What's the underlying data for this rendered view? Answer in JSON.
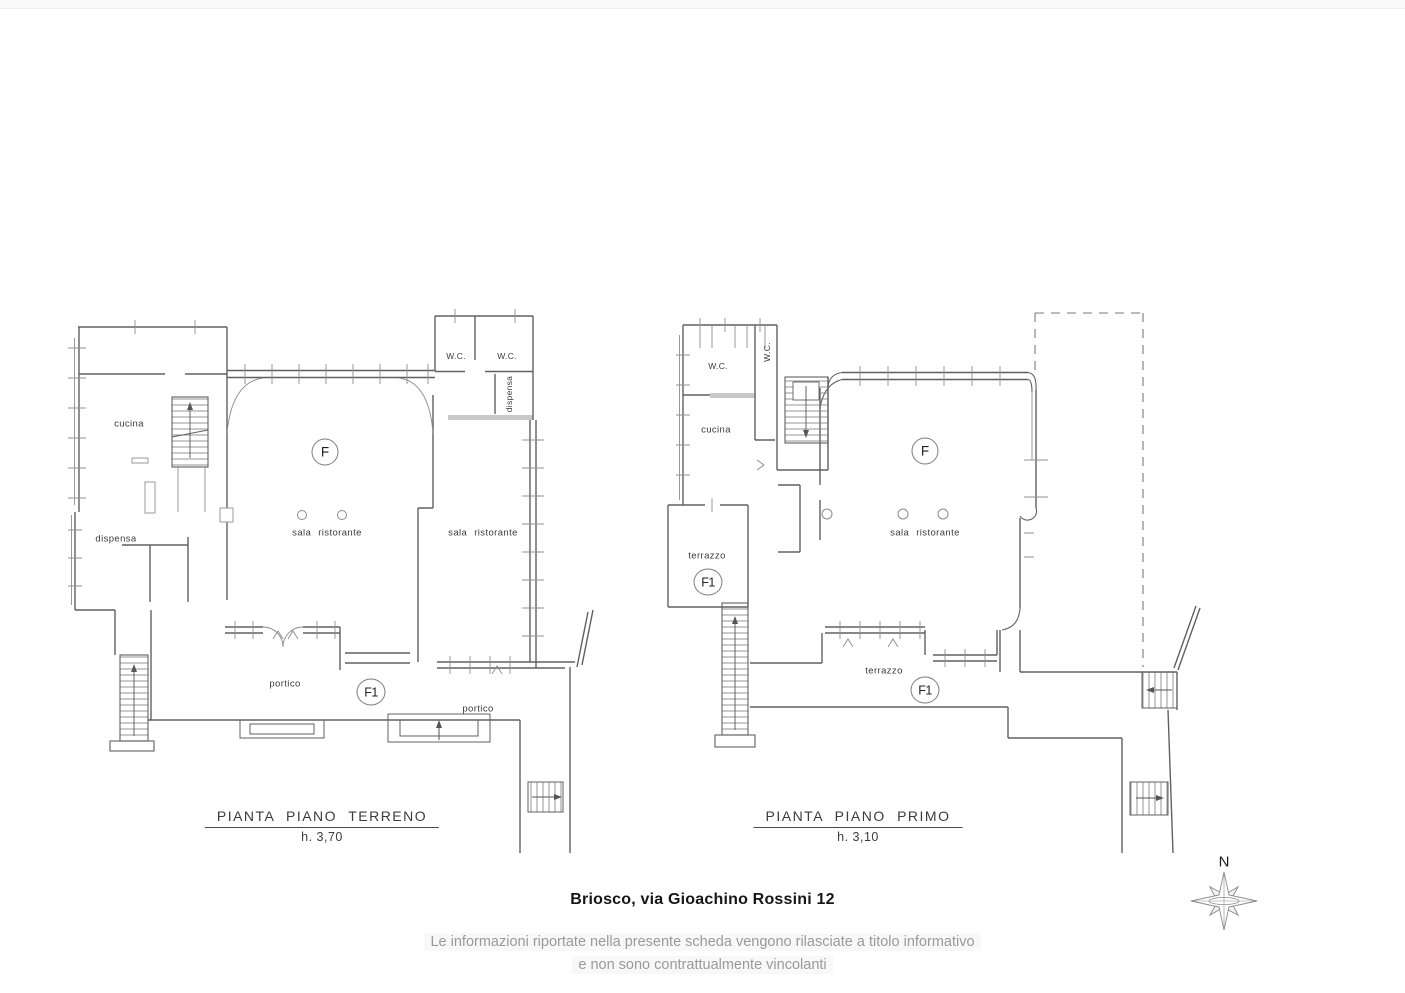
{
  "ground_floor": {
    "title": "PIANTA PIANO TERRENO",
    "height_label": "h. 3,70",
    "labels": {
      "cucina": "cucina",
      "dispensa_left": "dispensa",
      "wc_1": "W.C.",
      "wc_2": "W.C.",
      "dispensa_vertical": "dispensa",
      "sala_center": "sala ristorante",
      "sala_right": "sala ristorante",
      "portico_left": "portico",
      "portico_right": "portico",
      "unit_f": "F",
      "unit_f1": "F1"
    }
  },
  "first_floor": {
    "title": "PIANTA PIANO PRIMO",
    "height_label": "h. 3,10",
    "labels": {
      "wc_1": "W.C.",
      "wc_2": "W.C.",
      "cucina": "cucina",
      "sala": "sala ristorante",
      "terrazzo_left": "terrazzo",
      "terrazzo_center": "terrazzo",
      "unit_f": "F",
      "unit_f1_left": "F1",
      "unit_f1_center": "F1"
    }
  },
  "footer": {
    "address": "Briosco, via Gioachino Rossini 12",
    "disclaimer_line1": "Le informazioni riportate nella presente scheda vengono rilasciate a titolo informativo",
    "disclaimer_line2": "e non sono contrattualmente vincolanti"
  },
  "compass": {
    "north_label": "N"
  },
  "colors": {
    "wall_line": "#606060",
    "thin_line": "#909090",
    "gray_wall_fill": "#c9c9c9"
  }
}
